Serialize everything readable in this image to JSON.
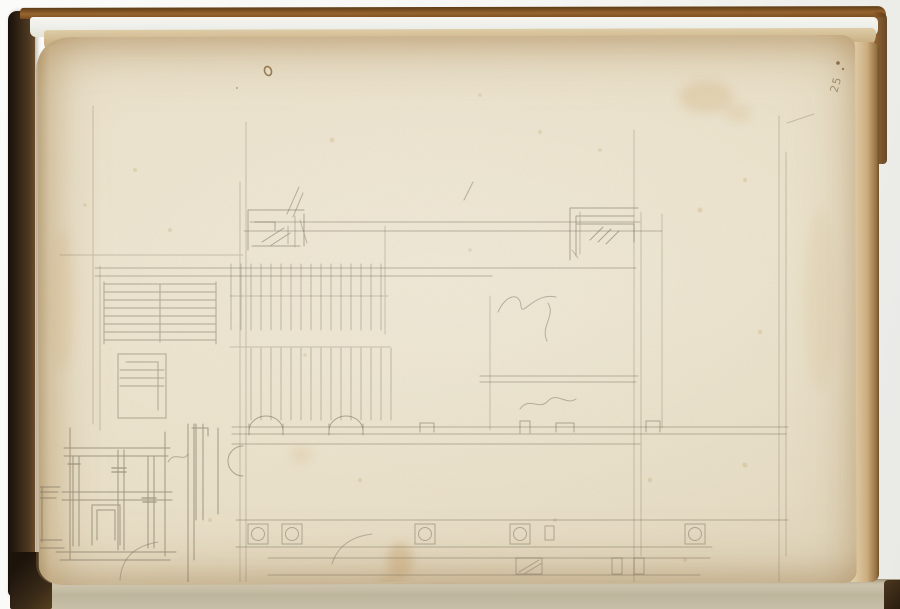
{
  "scene": {
    "type": "photograph of an open sketchbook page",
    "object": "leather-bound sketchbook, dark brown covers, cream toned paper",
    "drawing": "faint graphite architectural studies: building floor plan with staircase, hatched colonnade hall, wall with semicircular niches, row of column bases on square plinths; portal elevation study at lower left; small moulding/cornice details at upper left and upper right; illegible graphite scribbles",
    "medium": "graphite on cream paper"
  },
  "inscriptions": {
    "folio_number": "25",
    "scribbles": "illegible"
  },
  "palette": {
    "backdrop": "#f4f4f1",
    "page": "#eae1cb",
    "page_toning": "#d7c19a",
    "page_edges_tan": "#cdb488",
    "binding_leather_dark": "#2c2115",
    "binding_leather_brown": "#8a5827",
    "under_pages": "#c7bea6",
    "graphite": "#6e6555",
    "stain": "#b98a4e",
    "ink_speck": "#7d5a2e"
  }
}
